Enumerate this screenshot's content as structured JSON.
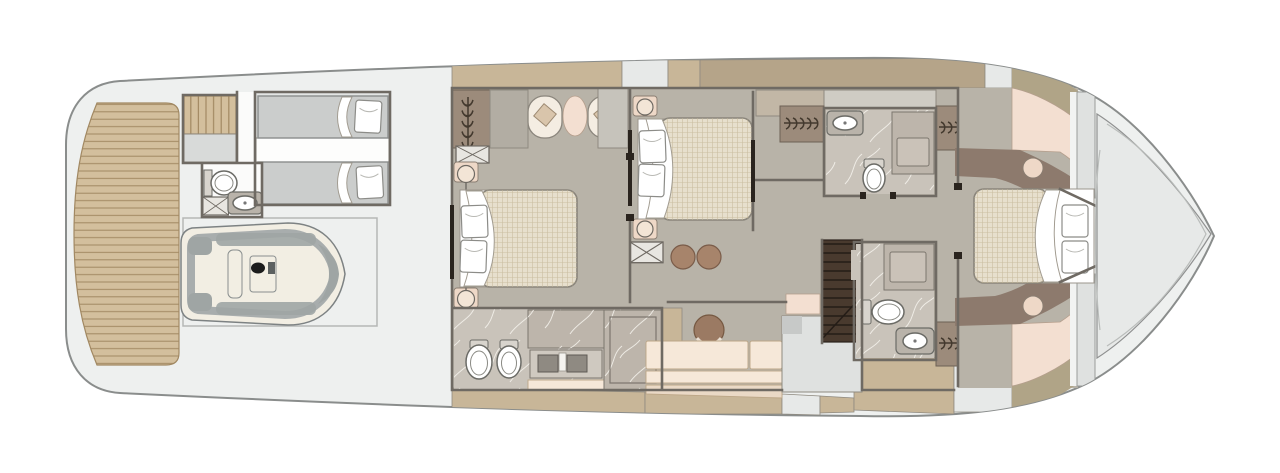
{
  "diagram": {
    "kind": "yacht interior deck floor plan",
    "orientation": "bow pointing right, top-down view",
    "label": "Yacht deck floor plan"
  },
  "palette": {
    "hull_fill": "#eef0ef",
    "hull_stroke": "#8a8d8c",
    "deck_gray": "#e7e9e8",
    "mid_gray": "#c9cbca",
    "teak": "#d3bf9d",
    "teak_line": "#a18862",
    "band_line": "#8f8a80",
    "tan_band": "#c8b698",
    "dark_tan": "#b5a489",
    "olive_band": "#b0a487",
    "floor_taupe": "#b8b3a8",
    "wall": "#6f6a63",
    "wall_dark": "#2a241e",
    "marble": "#c9c3ba",
    "marble_dark": "#bdb5ab",
    "bed_duvet": "#e7dfcd",
    "mattress_gray": "#cbcdcc",
    "pink_cream": "#f3dfd1",
    "lamp_beige": "#eed8c7",
    "cream_sofa": "#f6e8d9",
    "brown_stool": "#a7846b",
    "headboard_brown": "#8d7a6d",
    "wardrobe_brown": "#9c8b7b",
    "stairs_dark": "#493a2e",
    "tender_hull": "#f2eee3",
    "tender_gray": "#9fa5a4",
    "garage_line": "#b5b7b6"
  },
  "features": {
    "rooms": [
      "swim-platform",
      "stern-stairs",
      "crew-cabin",
      "crew-bathroom",
      "tender-garage",
      "guest-cabin-midship",
      "guest-bathroom-midship",
      "vip-cabin-midship",
      "walk-in-wardrobe",
      "main-staircase",
      "forward-bathroom-upper",
      "forward-bathroom-lower",
      "owner-cabin-bow",
      "bow-deck"
    ],
    "furniture": [
      "jet-tender",
      "twin-bed",
      "double-bed",
      "armchair",
      "side-table",
      "reading-lamp",
      "stool",
      "lounge-chair",
      "vanity-sofa",
      "toilet",
      "bidet",
      "sink",
      "shower",
      "hanging-locker",
      "luggage-rack",
      "teak-planking",
      "staircase-steps"
    ],
    "icon_shapes": {
      "hanging-locker": "row of hanger hooks on a rail",
      "luggage-rack": "crossed rectangle",
      "reading-lamp": "circle with stem",
      "teak-planking": "parallel plank lines"
    }
  }
}
